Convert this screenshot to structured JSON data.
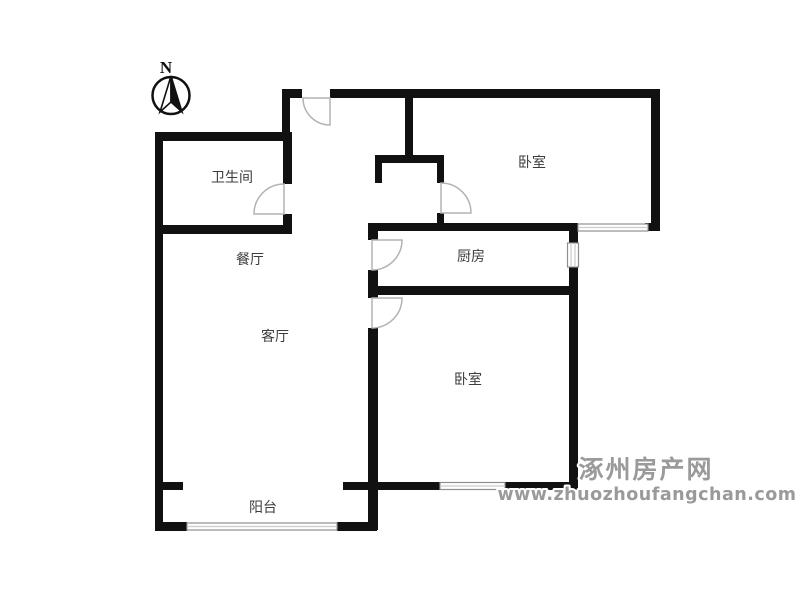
{
  "compass": {
    "north_label": "N"
  },
  "rooms": {
    "bathroom": {
      "label": "卫生间"
    },
    "dining": {
      "label": "餐厅"
    },
    "living": {
      "label": "客厅"
    },
    "kitchen": {
      "label": "厨房"
    },
    "bedroom_top": {
      "label": "卧室"
    },
    "bedroom_bottom": {
      "label": "卧室"
    },
    "balcony": {
      "label": "阳台"
    }
  },
  "watermark": {
    "site_name": "涿州房产网",
    "site_url": "www.zhuozhoufangchan.com"
  },
  "colors": {
    "wall": "#111111",
    "door_arc": "#b3b3b3",
    "window_frame": "#8f8f8f",
    "window_mid": "#cccccc",
    "label": "#3c3c3c",
    "watermark": "#9a9a9a",
    "watermark_halo": "#ffffff"
  }
}
